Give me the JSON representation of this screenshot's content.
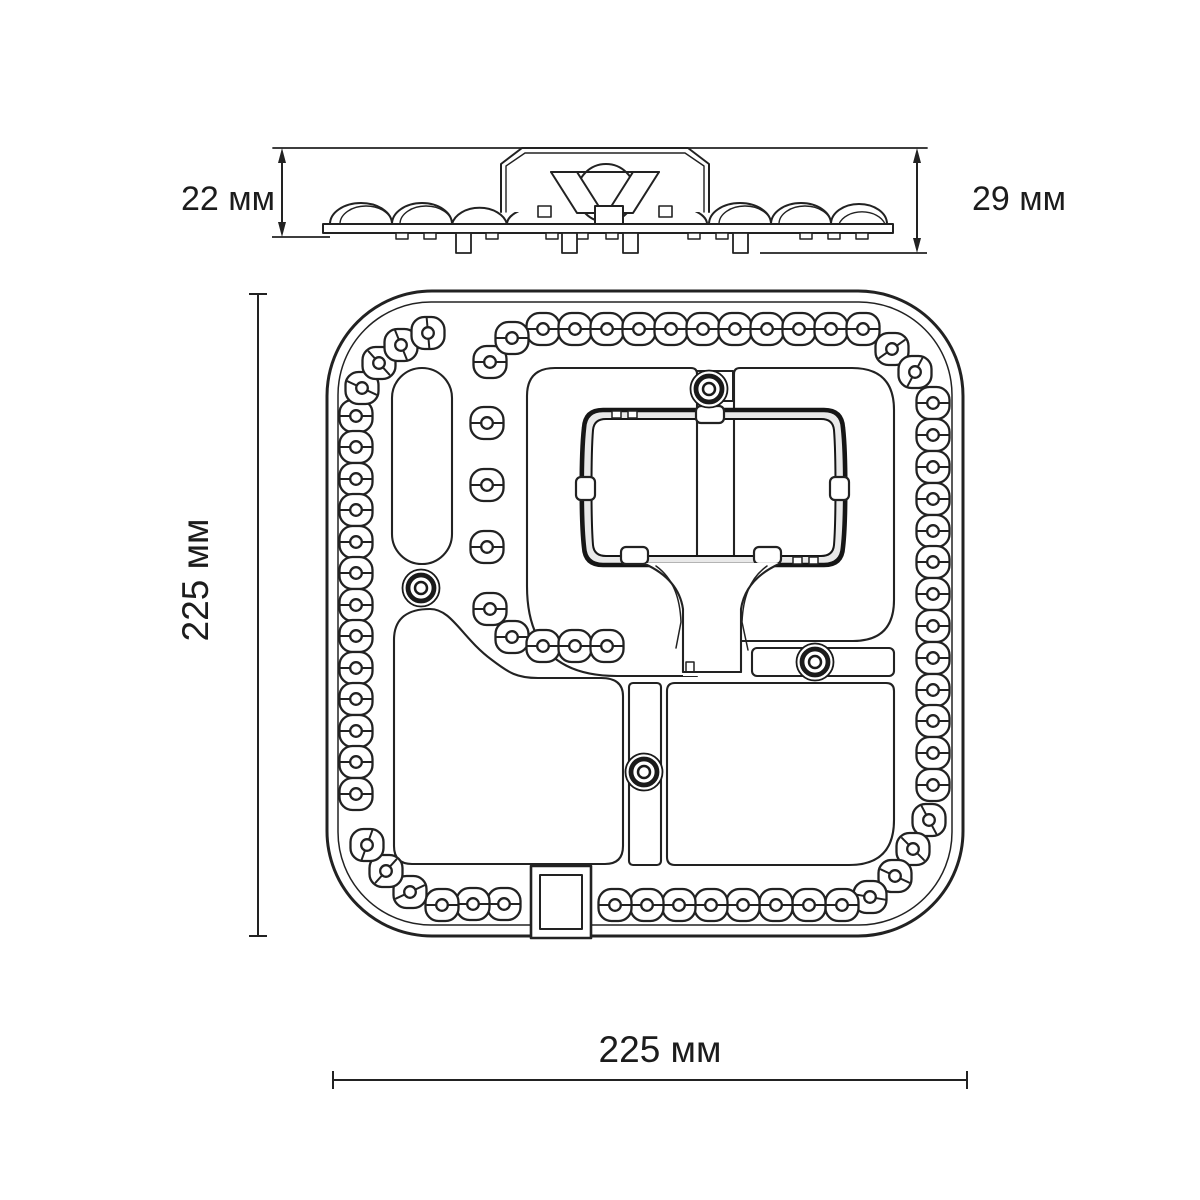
{
  "drawing": {
    "type": "technical-dimension-drawing",
    "subject": "LED module",
    "labels": {
      "side_height_left": "22 мм",
      "side_height_right": "29 мм",
      "top_view_width": "225 мм",
      "top_view_height": "225 мм"
    },
    "colors": {
      "line": "#222222",
      "bold_line": "#161616",
      "background": "#ffffff",
      "bracket_band": "#e9e9e9"
    },
    "led_lens": {
      "outer_w": 33,
      "outer_h": 32,
      "corner_r": 13,
      "hole_r": 5.8
    },
    "ring_leds": [
      [
        356,
        416,
        0
      ],
      [
        356,
        447,
        0
      ],
      [
        356,
        479,
        0
      ],
      [
        356,
        510,
        0
      ],
      [
        356,
        542,
        0
      ],
      [
        356,
        573,
        0
      ],
      [
        356,
        605,
        0
      ],
      [
        356,
        636,
        0
      ],
      [
        356,
        668,
        0
      ],
      [
        356,
        699,
        0
      ],
      [
        356,
        731,
        0
      ],
      [
        356,
        762,
        0
      ],
      [
        356,
        794,
        0
      ],
      [
        362,
        388,
        25
      ],
      [
        379,
        363,
        48
      ],
      [
        401,
        345,
        68
      ],
      [
        428,
        333,
        85
      ],
      [
        543,
        329,
        0
      ],
      [
        575,
        329,
        0
      ],
      [
        607,
        329,
        0
      ],
      [
        639,
        329,
        0
      ],
      [
        671,
        329,
        0
      ],
      [
        703,
        329,
        0
      ],
      [
        735,
        329,
        0
      ],
      [
        767,
        329,
        0
      ],
      [
        799,
        329,
        0
      ],
      [
        831,
        329,
        0
      ],
      [
        863,
        329,
        0
      ],
      [
        892,
        349,
        -35
      ],
      [
        915,
        372,
        -62
      ],
      [
        933,
        403,
        0
      ],
      [
        933,
        435,
        0
      ],
      [
        933,
        467,
        0
      ],
      [
        933,
        499,
        0
      ],
      [
        933,
        531,
        0
      ],
      [
        933,
        562,
        0
      ],
      [
        933,
        594,
        0
      ],
      [
        933,
        626,
        0
      ],
      [
        933,
        658,
        0
      ],
      [
        933,
        690,
        0
      ],
      [
        933,
        721,
        0
      ],
      [
        933,
        753,
        0
      ],
      [
        933,
        785,
        0
      ],
      [
        929,
        820,
        62
      ],
      [
        913,
        849,
        45
      ],
      [
        895,
        876,
        25
      ],
      [
        870,
        897,
        10
      ],
      [
        842,
        905,
        0
      ],
      [
        809,
        905,
        0
      ],
      [
        776,
        905,
        0
      ],
      [
        743,
        905,
        0
      ],
      [
        711,
        905,
        0
      ],
      [
        679,
        905,
        0
      ],
      [
        647,
        905,
        0
      ],
      [
        615,
        905,
        0
      ],
      [
        504,
        904,
        0
      ],
      [
        473,
        904,
        0
      ],
      [
        442,
        905,
        0
      ],
      [
        410,
        892,
        -25
      ],
      [
        386,
        871,
        -48
      ],
      [
        367,
        845,
        -70
      ]
    ],
    "inner_leds": [
      [
        490,
        362,
        0
      ],
      [
        512,
        338,
        0
      ],
      [
        487,
        423,
        0
      ],
      [
        487,
        485,
        0
      ],
      [
        487,
        547,
        0
      ],
      [
        490,
        609,
        0
      ],
      [
        512,
        637,
        0
      ],
      [
        543,
        646,
        0
      ],
      [
        575,
        646,
        0
      ],
      [
        607,
        646,
        0
      ]
    ],
    "screws": [
      [
        709,
        389
      ],
      [
        421,
        588
      ],
      [
        815,
        662
      ],
      [
        644,
        772
      ]
    ]
  }
}
